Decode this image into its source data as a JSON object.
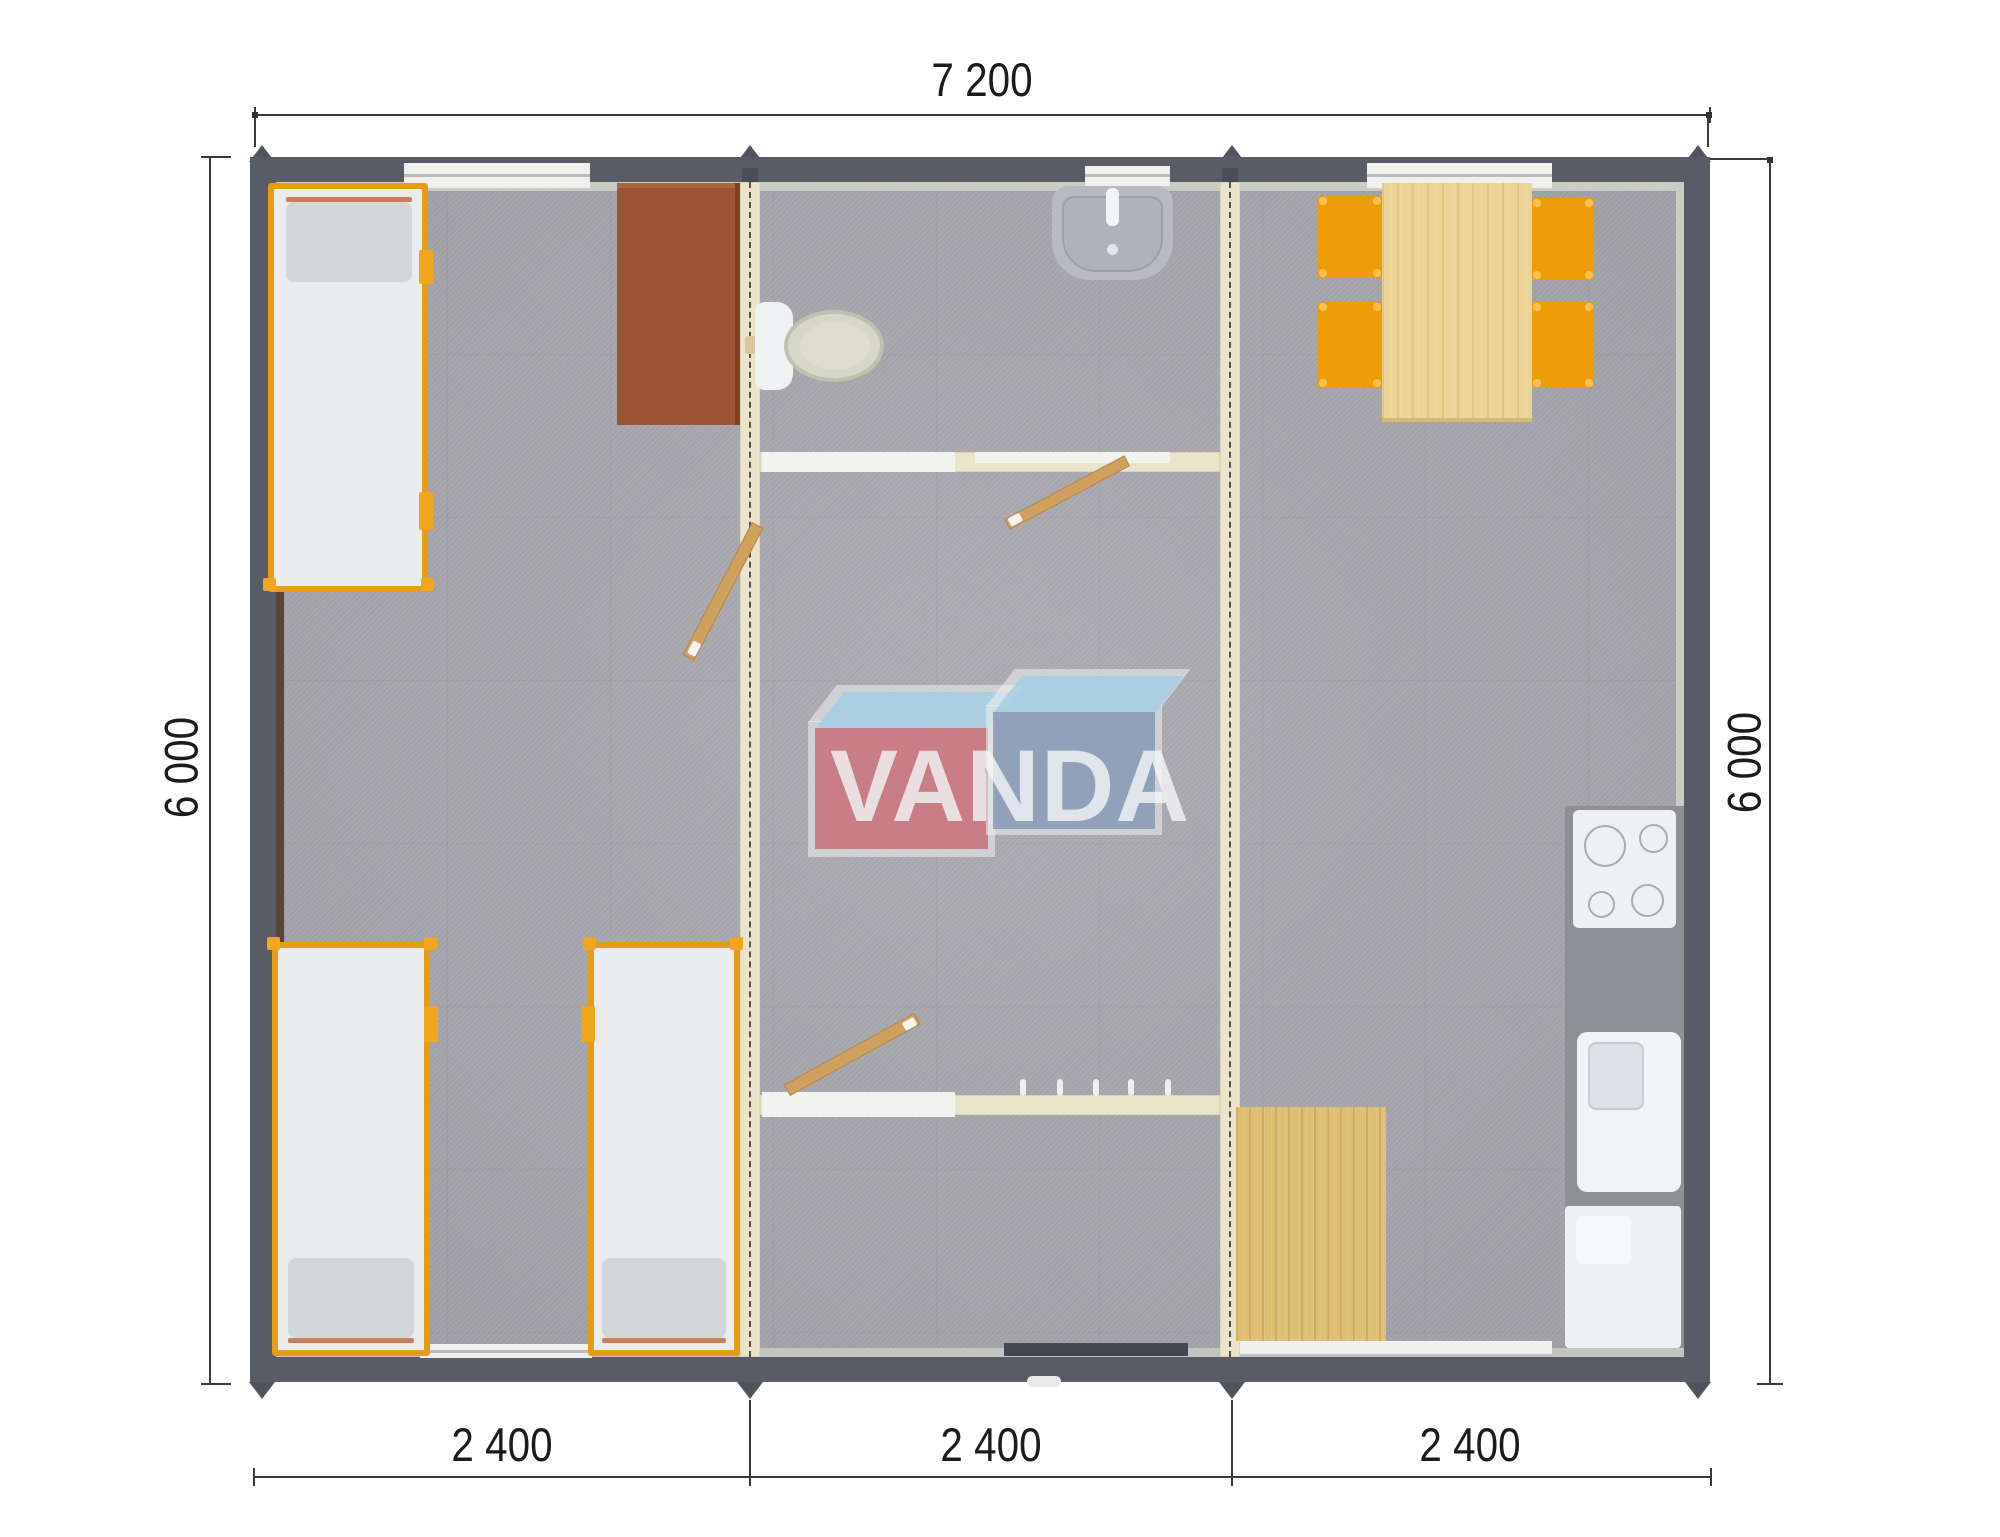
{
  "plan": {
    "logo_text": "VANDA",
    "dimensions": {
      "width_total": "7 200",
      "height_left": "6 000",
      "height_right": "6 000",
      "modules": [
        "2 400",
        "2 400",
        "2 400"
      ]
    },
    "colors": {
      "wall": "#585c66",
      "partition": "#ebe4cb",
      "carpet": "#a9a8ae",
      "bed_frame": "#e69c13",
      "chair": "#ee9d09",
      "table_wood": "#ecd496",
      "door_wood": "#cfa05e",
      "desk": "#9b5434",
      "logo_red": "#c76872",
      "logo_blue": "#7f94b1",
      "logo_light_blue": "#a3cde3"
    }
  }
}
